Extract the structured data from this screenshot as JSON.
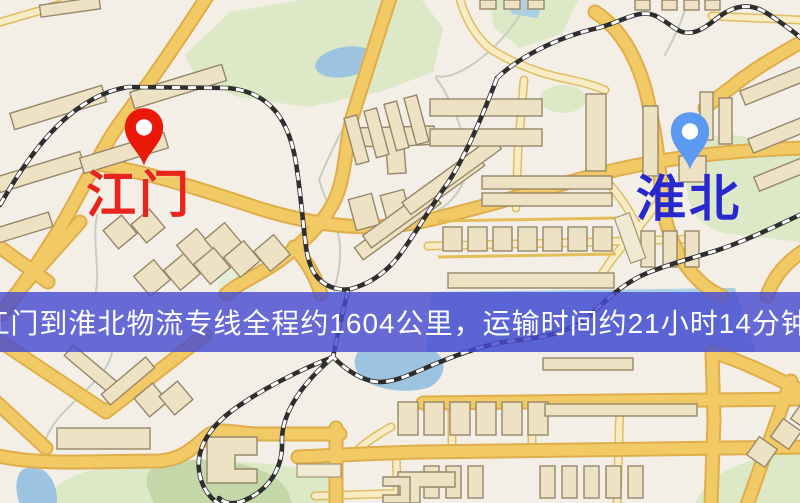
{
  "app": {
    "type": "map-route-view"
  },
  "banner": {
    "text": "江门到淮北物流专线全程约1604公里，运输时间约21小时14分钟.",
    "origin": "江门",
    "destination": "淮北",
    "distance": "1604公里",
    "duration": "21小时14分钟"
  },
  "markers": {
    "origin": {
      "label": "江门",
      "icon": "map-pin"
    },
    "destination": {
      "label": "淮北",
      "icon": "map-pin"
    }
  },
  "palette": {
    "map-bg": "#f3efe7",
    "road-fill": "#f1ca66",
    "road-casing": "#dfae4b",
    "park": "#dce8c6",
    "water": "#9cc4e0",
    "building": "#eee2c4",
    "railway": "#2e2e2e",
    "origin-pin": "#ea1808",
    "origin-label": "#e8251a",
    "dest-pin": "#5b9af0",
    "dest-label": "#2828cf",
    "banner-bg": "rgba(72,76,208,0.82)",
    "banner-text": "#ffffff"
  }
}
